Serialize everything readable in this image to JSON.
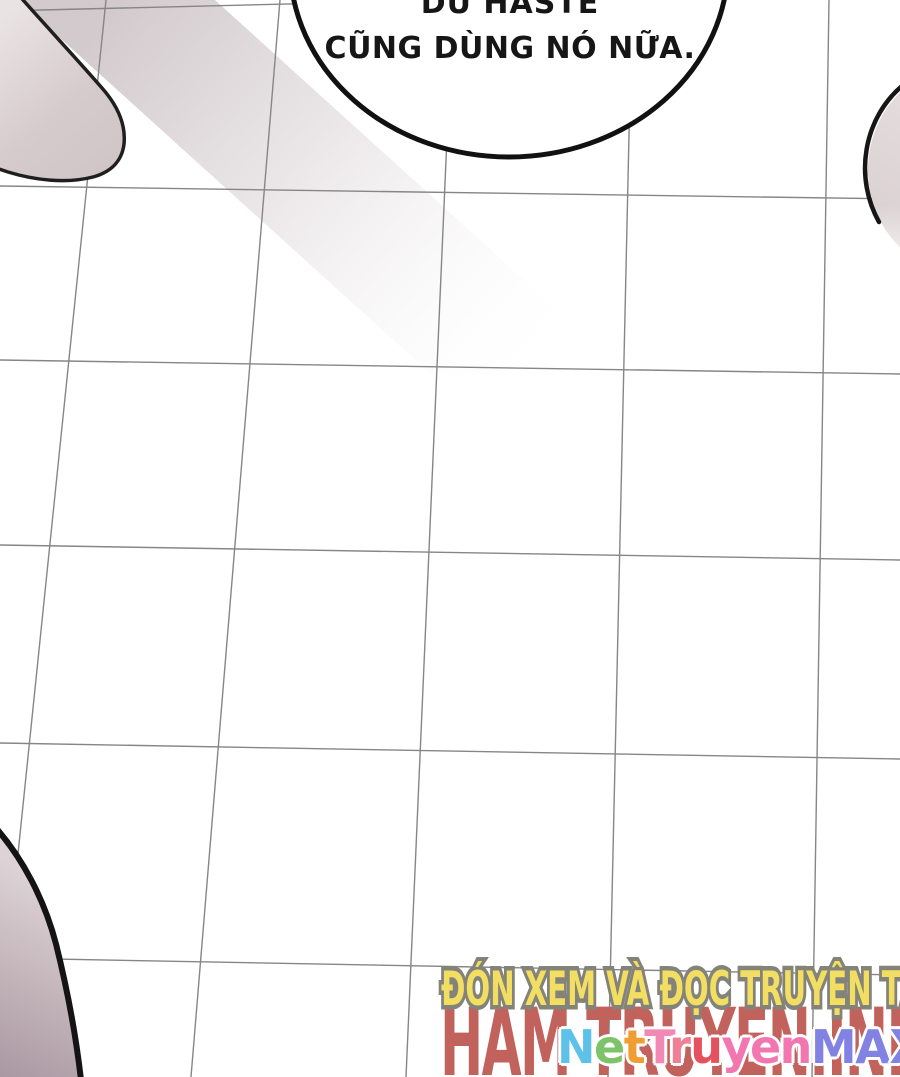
{
  "page": {
    "background": "#ffffff"
  },
  "speech_bubble": {
    "line1": "DU HASTE",
    "line2": "CŨNG DÙNG NÓ NỮA."
  },
  "promo": {
    "tagline": "ĐÓN XEM VÀ ĐỌC TRUYỆN TẠI",
    "tagline_fill": "#f2de62",
    "tagline_outline": "#84837a",
    "site_name": "HAM TRUYEN.INFO",
    "site_color": "#c2625c"
  },
  "watermark": {
    "text": "NetTruyenMAX",
    "outline_color": "#ffffff",
    "letters": [
      {
        "ch": "N",
        "color": "#5ec1e8"
      },
      {
        "ch": "e",
        "color": "#7cc36a"
      },
      {
        "ch": "t",
        "color": "#f09d32"
      },
      {
        "ch": "T",
        "color": "#f288b4"
      },
      {
        "ch": "r",
        "color": "#ef8095"
      },
      {
        "ch": "u",
        "color": "#e6515e"
      },
      {
        "ch": "y",
        "color": "#f277b0"
      },
      {
        "ch": "e",
        "color": "#f277b0"
      },
      {
        "ch": "n",
        "color": "#f277b0"
      },
      {
        "ch": "M",
        "color": "#8282e2"
      },
      {
        "ch": "A",
        "color": "#8282e2"
      },
      {
        "ch": "X",
        "color": "#8282e2"
      }
    ]
  },
  "artwork": {
    "grid_line_color": "#868686",
    "outline_color": "#161616",
    "shade_light": "#eae3e3",
    "shade_dark": "#a2909a",
    "bubble_fill": "#ffffff"
  }
}
